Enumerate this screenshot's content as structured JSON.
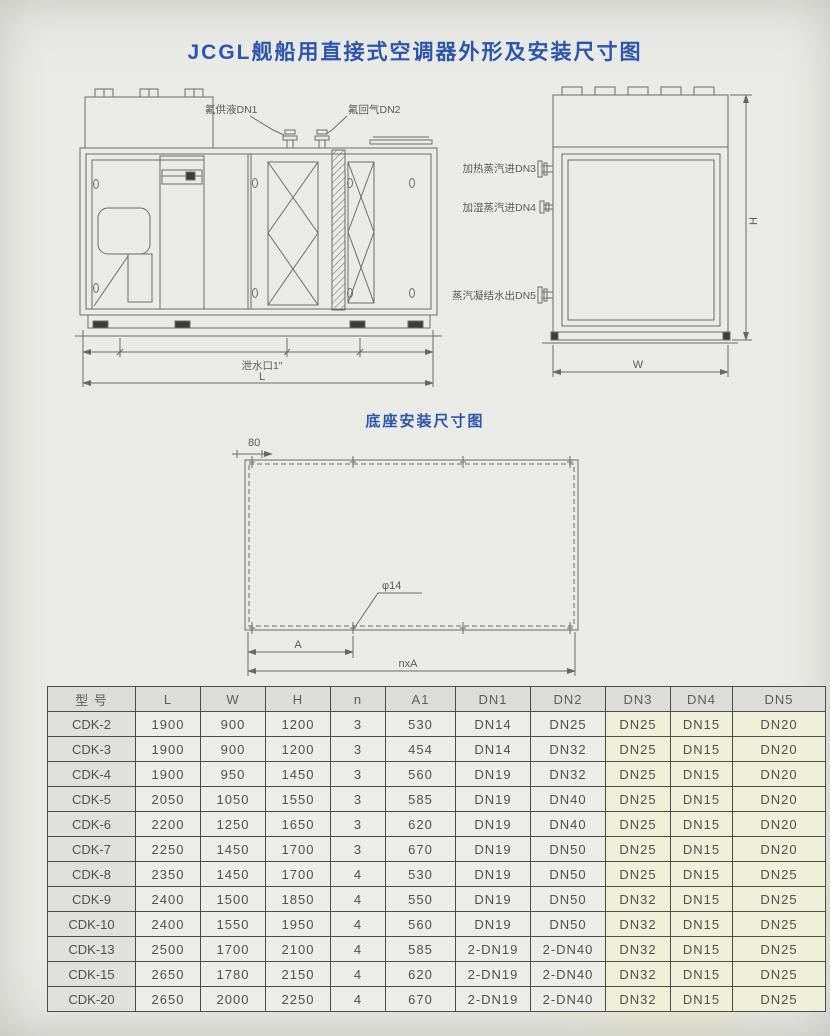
{
  "page": {
    "title": "JCGL舰船用直接式空调器外形及安装尺寸图"
  },
  "front_view": {
    "labels": {
      "dn1": "氟供液DN1",
      "dn2": "氟回气DN2",
      "drain": "泄水口1\"",
      "length": "L"
    }
  },
  "side_view": {
    "labels": {
      "dn3": "加热蒸汽进DN3",
      "dn4": "加湿蒸汽进DN4",
      "dn5": "蒸汽凝结水出DN5",
      "width": "W",
      "height": "H"
    }
  },
  "base_diagram": {
    "title": "底座安装尺寸图",
    "labels": {
      "offset": "80",
      "hole": "φ14",
      "pitch": "A",
      "total": "nxA"
    }
  },
  "table": {
    "columns": [
      "型 号",
      "L",
      "W",
      "H",
      "n",
      "A1",
      "DN1",
      "DN2",
      "DN3",
      "DN4",
      "DN5"
    ],
    "rows": [
      [
        "CDK-2",
        "1900",
        "900",
        "1200",
        "3",
        "530",
        "DN14",
        "DN25",
        "DN25",
        "DN15",
        "DN20"
      ],
      [
        "CDK-3",
        "1900",
        "900",
        "1200",
        "3",
        "454",
        "DN14",
        "DN32",
        "DN25",
        "DN15",
        "DN20"
      ],
      [
        "CDK-4",
        "1900",
        "950",
        "1450",
        "3",
        "560",
        "DN19",
        "DN32",
        "DN25",
        "DN15",
        "DN20"
      ],
      [
        "CDK-5",
        "2050",
        "1050",
        "1550",
        "3",
        "585",
        "DN19",
        "DN40",
        "DN25",
        "DN15",
        "DN20"
      ],
      [
        "CDK-6",
        "2200",
        "1250",
        "1650",
        "3",
        "620",
        "DN19",
        "DN40",
        "DN25",
        "DN15",
        "DN20"
      ],
      [
        "CDK-7",
        "2250",
        "1450",
        "1700",
        "3",
        "670",
        "DN19",
        "DN50",
        "DN25",
        "DN15",
        "DN20"
      ],
      [
        "CDK-8",
        "2350",
        "1450",
        "1700",
        "4",
        "530",
        "DN19",
        "DN50",
        "DN25",
        "DN15",
        "DN25"
      ],
      [
        "CDK-9",
        "2400",
        "1500",
        "1850",
        "4",
        "550",
        "DN19",
        "DN50",
        "DN32",
        "DN15",
        "DN25"
      ],
      [
        "CDK-10",
        "2400",
        "1550",
        "1950",
        "4",
        "560",
        "DN19",
        "DN50",
        "DN32",
        "DN15",
        "DN25"
      ],
      [
        "CDK-13",
        "2500",
        "1700",
        "2100",
        "4",
        "585",
        "2-DN19",
        "2-DN40",
        "DN32",
        "DN15",
        "DN25"
      ],
      [
        "CDK-15",
        "2650",
        "1780",
        "2150",
        "4",
        "620",
        "2-DN19",
        "2-DN40",
        "DN32",
        "DN15",
        "DN25"
      ],
      [
        "CDK-20",
        "2650",
        "2000",
        "2250",
        "4",
        "670",
        "2-DN19",
        "2-DN40",
        "DN32",
        "DN15",
        "DN25"
      ]
    ]
  }
}
